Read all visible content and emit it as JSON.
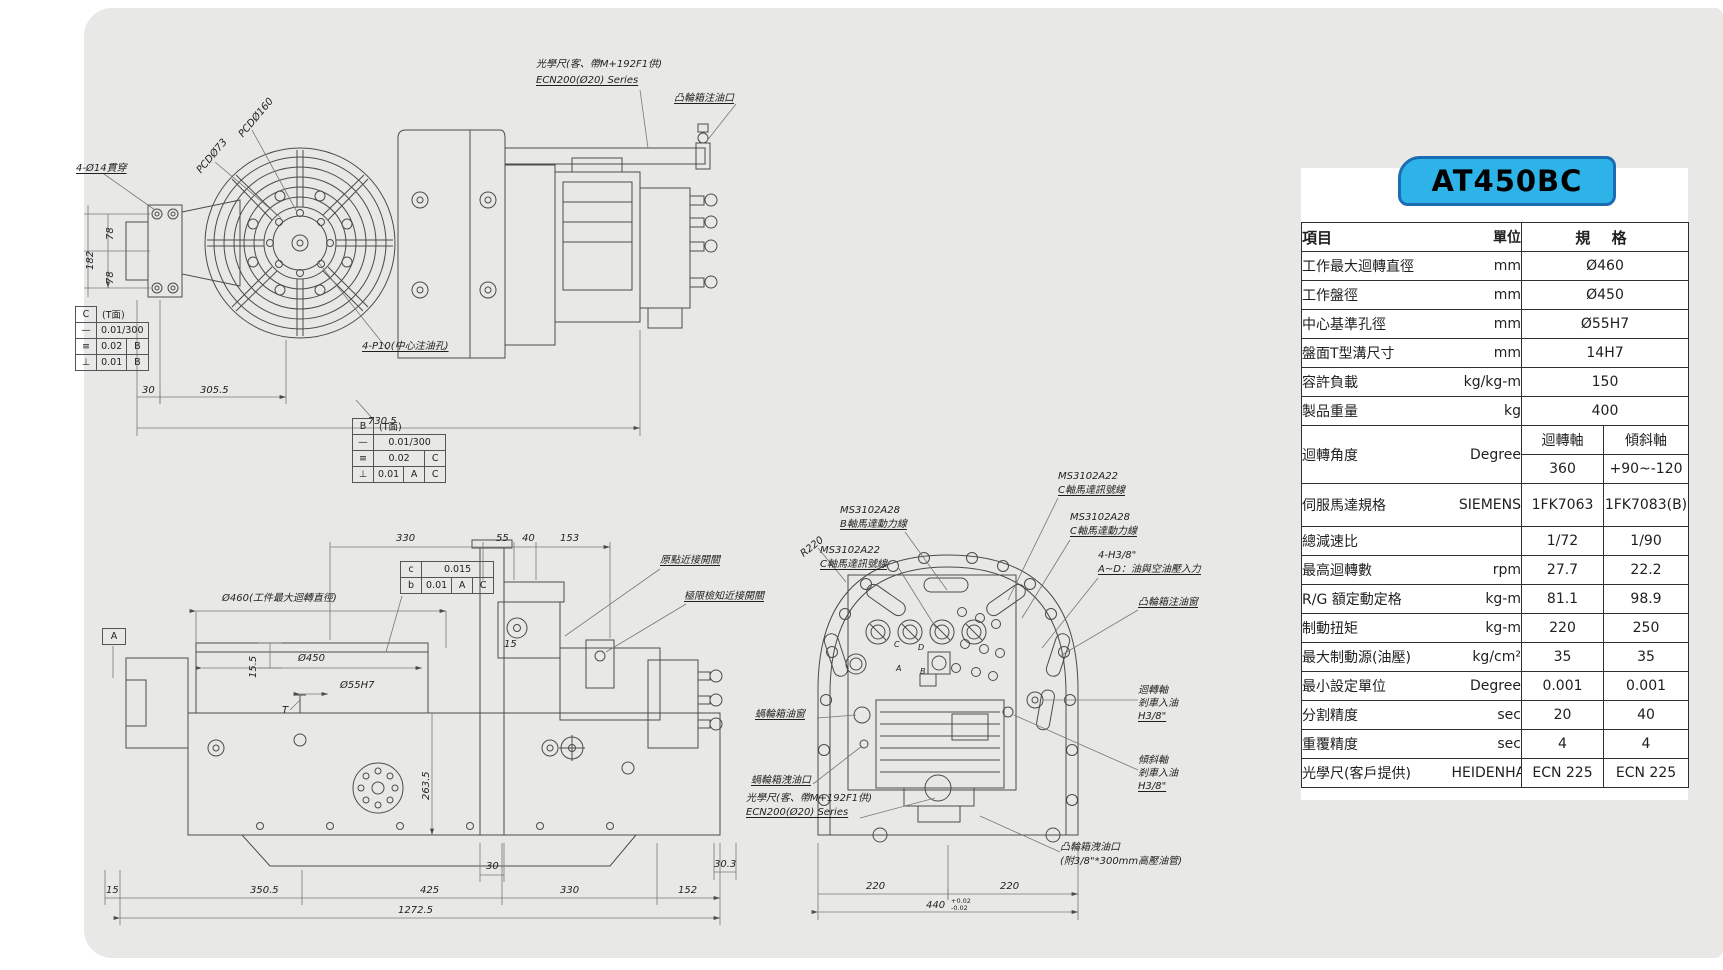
{
  "model": "AT450BC",
  "colors": {
    "badge_bg": "#2db3e8",
    "badge_border": "#1a6db3",
    "sheet_bg": "#e8e8e6",
    "line": "#4b4b4b"
  },
  "spec": {
    "header": {
      "item": "項目",
      "unit": "單位",
      "spec": "規 格"
    },
    "rows": [
      {
        "item": "工作最大迴轉直徑",
        "unit": "mm",
        "v1": "Ø460"
      },
      {
        "item": "工作盤徑",
        "unit": "mm",
        "v1": "Ø450"
      },
      {
        "item": "中心基準孔徑",
        "unit": "mm",
        "v1": "Ø55H7"
      },
      {
        "item": "盤面T型溝尺寸",
        "unit": "mm",
        "v1": "14H7"
      },
      {
        "item": "容許負載",
        "unit": "kg/kg-m",
        "v1": "150"
      },
      {
        "item": "製品重量",
        "unit": "kg",
        "v1": "400"
      },
      {
        "item": "迴轉角度",
        "unit": "Degree",
        "h1": "迴轉軸",
        "h2": "傾斜軸",
        "v1": "360",
        "v2": "+90~-120"
      },
      {
        "item": "伺服馬達規格",
        "unit": "SIEMENS",
        "v1": "1FK7063",
        "v2": "1FK7083(B)"
      },
      {
        "item": "總減速比",
        "unit": "",
        "v1": "1/72",
        "v2": "1/90"
      },
      {
        "item": "最高迴轉數",
        "unit": "rpm",
        "v1": "27.7",
        "v2": "22.2"
      },
      {
        "item": "R/G 額定動定格",
        "unit": "kg-m",
        "v1": "81.1",
        "v2": "98.9"
      },
      {
        "item": "制動扭矩",
        "unit": "kg-m",
        "v1": "220",
        "v2": "250"
      },
      {
        "item": "最大制動源(油壓)",
        "unit": "kg/cm²",
        "v1": "35",
        "v2": "35"
      },
      {
        "item": "最小設定單位",
        "unit": "Degree",
        "v1": "0.001",
        "v2": "0.001"
      },
      {
        "item": "分割精度",
        "unit": "sec",
        "v1": "20",
        "v2": "40"
      },
      {
        "item": "重覆精度",
        "unit": "sec",
        "v1": "4",
        "v2": "4"
      },
      {
        "item": "光學尺(客戶提供)",
        "unit": "HEIDENHAIN",
        "v1": "ECN 225",
        "v2": "ECN 225"
      }
    ]
  },
  "fv": {
    "holes": "4-Ø14貫穿",
    "pcd160": "PCDØ160",
    "pcd73": "PCDØ73",
    "scale1": "光學尺(客、帶M+192F1供)",
    "scale2": "ECN200(Ø20) Series",
    "cam_fill": "凸輪箱注油口",
    "p10": "4-P10(中心注油孔)",
    "d78a": "78",
    "d78b": "78",
    "d182": "182",
    "d30": "30",
    "d3055": "305.5",
    "d7305": "730.5"
  },
  "gdt_c": {
    "datum": "C",
    "note": "(T面)",
    "r1s": "—",
    "r1v": "0.01/300",
    "r2s": "≡",
    "r2v": "0.02",
    "r2d": "B",
    "r3s": "⊥",
    "r3v": "0.01",
    "r3d": "B"
  },
  "gdt_b": {
    "datum": "B",
    "note": "(T面)",
    "r1s": "—",
    "r1v": "0.01/300",
    "r2s": "≡",
    "r2v": "0.02",
    "r2d": "C",
    "r3s": "⊥",
    "r3v": "0.01",
    "r3d1": "A",
    "r3d2": "C"
  },
  "sv": {
    "datum_a": "A",
    "dia460": "Ø460(工件最大迴轉直徑)",
    "dia450": "Ø450",
    "dia55": "Ø55H7",
    "d155": "15.5",
    "t": "T",
    "d15": "15",
    "tc_s": "c",
    "tc_v": "0.015",
    "tb_s": "b",
    "tb_v": "0.01",
    "tb_d1": "A",
    "tb_d2": "C",
    "origin_sw": "原點近接開關",
    "limit_sw": "極限檢知近接開關",
    "d330": "330",
    "d55": "55",
    "d40": "40",
    "d153": "153",
    "d2635": "263.5",
    "d30": "30",
    "d303": "30.3",
    "b15": "15",
    "b3505": "350.5",
    "b425": "425",
    "b330": "330",
    "b152": "152",
    "b12725": "1272.5"
  },
  "rv": {
    "ms1a": "MS3102A28",
    "ms1b": "B軸馬達動力線",
    "ms2a": "MS3102A22",
    "ms2b": "C軸馬達訊號線",
    "ms3a": "MS3102A22",
    "ms3b": "C軸馬達訊號線",
    "ms4a": "MS3102A28",
    "ms4b": "C軸馬達動力線",
    "h38a": "4-H3/8\"",
    "h38b": "A~D：油與空油壓入力",
    "cam_fill_window": "凸輪箱注油窗",
    "r220": "R220",
    "rot_axis": "迴轉軸",
    "rot_brake": "剎車入油",
    "rot_size": "H3/8\"",
    "tilt_axis": "傾斜軸",
    "tilt_brake": "剎車入油",
    "tilt_size": "H3/8\"",
    "worm_window": "蝸輪箱油窗",
    "worm_drain": "蝸輪箱洩油口",
    "scale1": "光學尺(客、帶M+192F1供)",
    "scale2": "ECN200(Ø20) Series",
    "cam_drain1": "凸輪箱洩油口",
    "cam_drain2": "(附3/8\"*300mm高壓油管)",
    "d220a": "220",
    "d220b": "220",
    "d440": "440",
    "tol_u": "+0.02",
    "tol_l": "-0.02",
    "pA": "A",
    "pB": "B",
    "pC": "C",
    "pD": "D"
  }
}
